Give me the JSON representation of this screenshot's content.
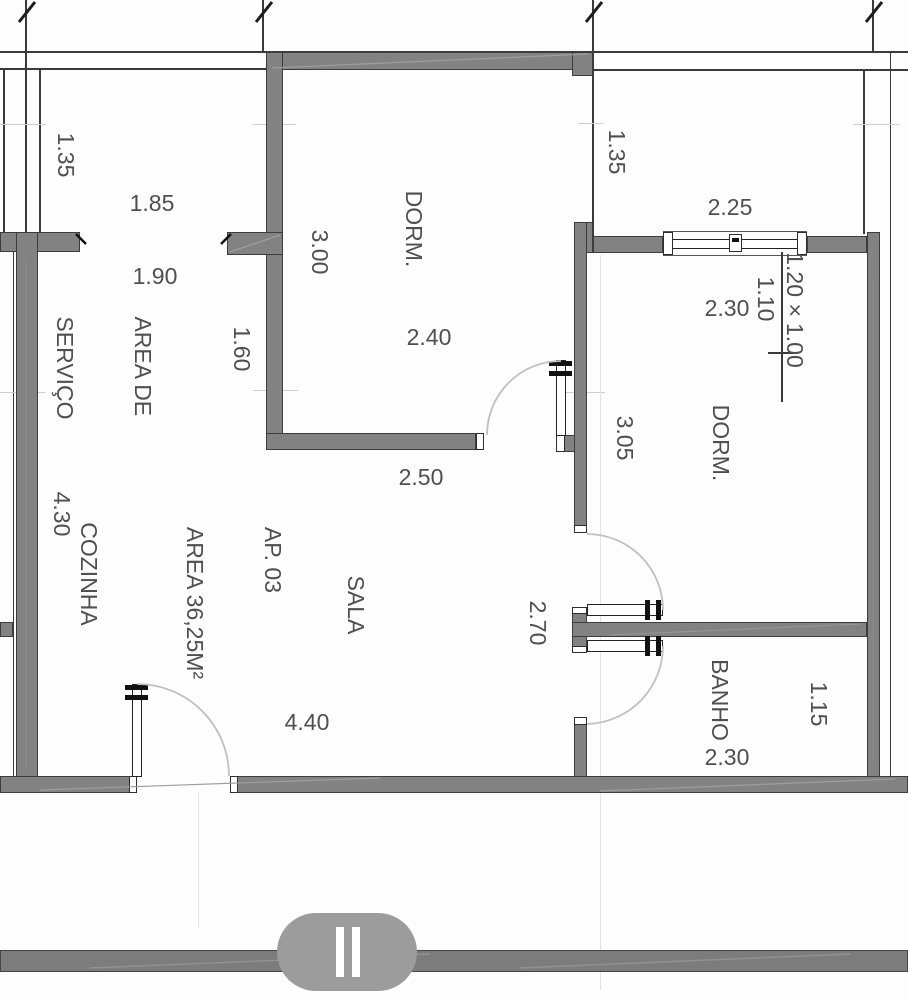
{
  "plan": {
    "apartment": {
      "line1": "AP. 03",
      "line2": "AREA 36,25M²"
    },
    "rooms": {
      "dorm_left": "DORM.",
      "dorm_right": "DORM.",
      "sala": "SALA",
      "cozinha": "COZINHA",
      "banho": "BANHO",
      "servico_line1": "AREA DE",
      "servico_line2": "SERVIÇO"
    },
    "dimensions": {
      "balcony_left_depth": "1.35",
      "balcony_left_width": "1.85",
      "servico_width": "1.90",
      "servico_depth": "1.60",
      "left_column_height": "4.30",
      "dorm_left_height": "3.00",
      "dorm_left_width": "2.40",
      "sala_top_width": "2.50",
      "sala_bottom_width": "4.40",
      "balcony_right_depth": "1.35",
      "balcony_right_width": "2.25",
      "window_wall_width": "2.30",
      "dorm_right_height": "3.05",
      "hall_height": "2.70",
      "banho_depth": "1.15",
      "banho_width": "2.30"
    },
    "window_note": {
      "size": "1.20×1.00",
      "sill": "1.10"
    },
    "colors": {
      "wall": "#828282",
      "line": "#3a3a3a",
      "text": "#4f4f4f",
      "door_arc": "#c0c0c0",
      "corridor_bar": "#7c7c7c",
      "section_marker": "#9c9c9c"
    }
  }
}
